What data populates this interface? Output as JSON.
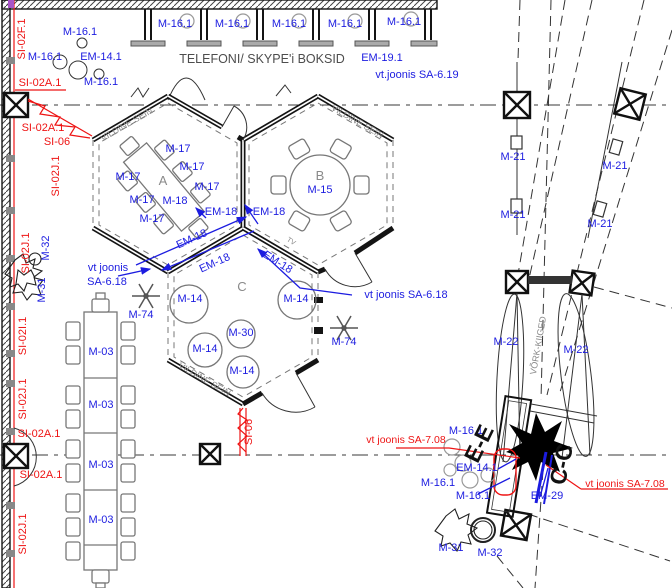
{
  "drawing": {
    "kind": "architectural-floor-plan",
    "colors": {
      "annotation_blue": "#1c1ce0",
      "annotation_red": "#ee1414",
      "wall_black": "#141414",
      "furniture_gray": "#777777",
      "text_gray": "#8a8a8a"
    },
    "texts": {
      "m16_1": "M-16.1",
      "em14_1": "EM-14.1",
      "em19_1": "EM-19.1",
      "vt_joonis_sa_6_19": "vt.joonis SA-6.19",
      "telefoni": "TELEFONI/ SKYPE'i BOKSID",
      "vildine_sein": "VILDINE SEIN",
      "m17": "M-17",
      "m18": "M-18",
      "em18": "EM-18",
      "m15": "M-15",
      "m14": "M-14",
      "m30": "M-30",
      "m74": "M-74",
      "m03": "M-03",
      "m21": "M-21",
      "m22": "M-22",
      "m31": "M-31",
      "m32": "M-32",
      "em29": "EM-29",
      "room_a": "A",
      "room_b": "B",
      "room_c": "C",
      "vork_kiiged": "VÕRK-KIIGED",
      "tv": "TV",
      "vt_joonis": "vt joonis",
      "sa_6_18": "SA-6.18",
      "vt_joonis_sa_6_18": "vt joonis SA-6.18",
      "vt_joonis_sa_7_08": "vt joonis SA-7.08",
      "si_02f_1": "SI-02F.1",
      "si_02a_1": "SI-02A.1",
      "si_06": "SI-06",
      "si_02j_1": "SI-02J.1",
      "si_02i_1": "SI-02I.1",
      "section_ee": "E-E",
      "section_cc": "C-C"
    }
  }
}
